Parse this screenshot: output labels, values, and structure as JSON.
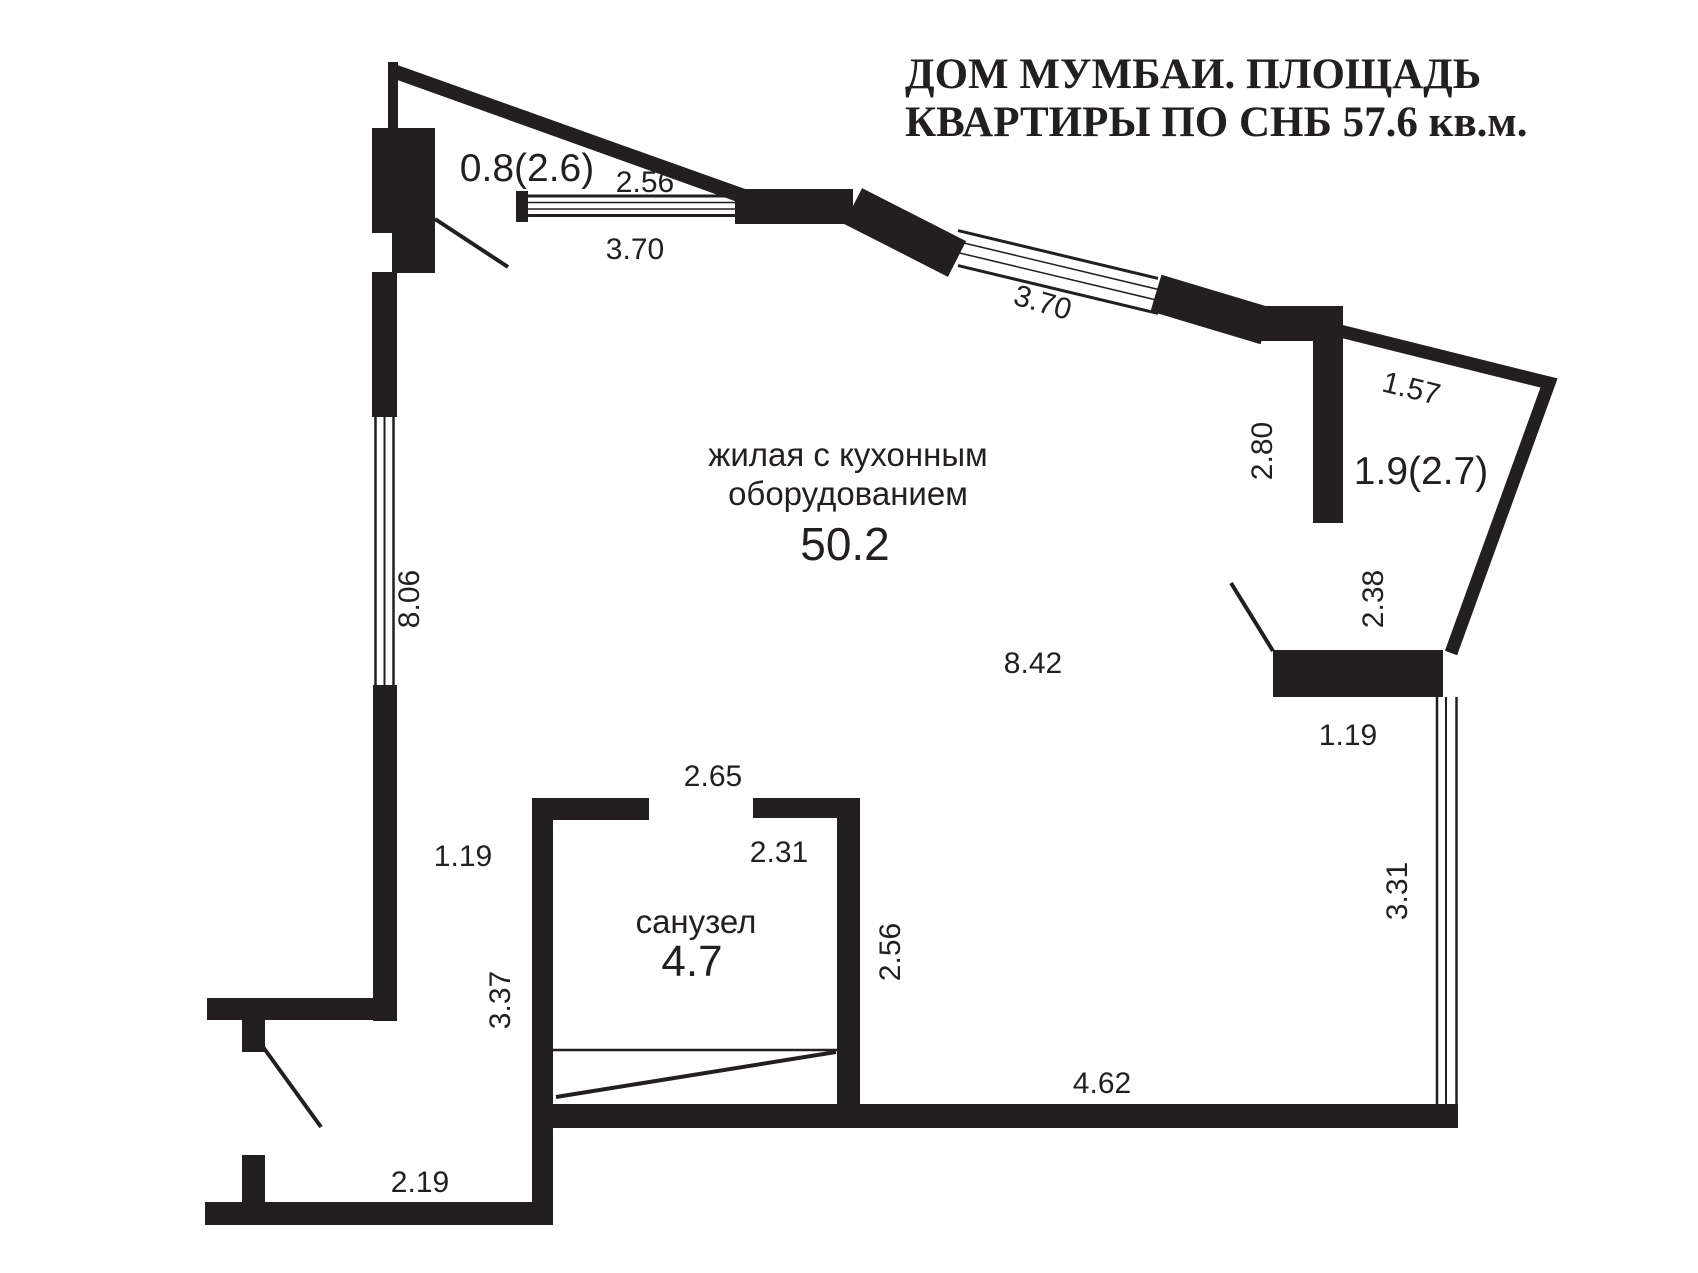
{
  "title": {
    "line1": "ДОМ МУМБАИ. ПЛОЩАДЬ",
    "line2": "КВАРТИРЫ ПО СНБ 57.6 кв.м.",
    "color": "#e01b1f"
  },
  "rooms": {
    "living": {
      "label_line1": "жилая с кухонным",
      "label_line2": "оборудованием",
      "area": "50.2"
    },
    "bathroom": {
      "label": "санузел",
      "area": "4.7"
    },
    "balcony_top": {
      "area": "0.8(2.6)"
    },
    "balcony_right": {
      "area": "1.9(2.7)"
    }
  },
  "dims": {
    "top_window_inner": "2.56",
    "top_window_outer": "3.70",
    "diag_window": "3.70",
    "right_upper": "1.57",
    "right_vertical": "2.80",
    "balcony_right_width": "2.38",
    "left_wall": "8.06",
    "living_width": "8.42",
    "right_opening": "1.19",
    "right_window": "3.31",
    "bath_top": "2.65",
    "bath_inner_width": "2.31",
    "bath_inner_height": "2.56",
    "bath_left_height": "3.37",
    "entry_opening": "1.19",
    "bottom_wall": "4.62",
    "entry_width": "2.19"
  },
  "colors": {
    "wall": "#231f20"
  }
}
